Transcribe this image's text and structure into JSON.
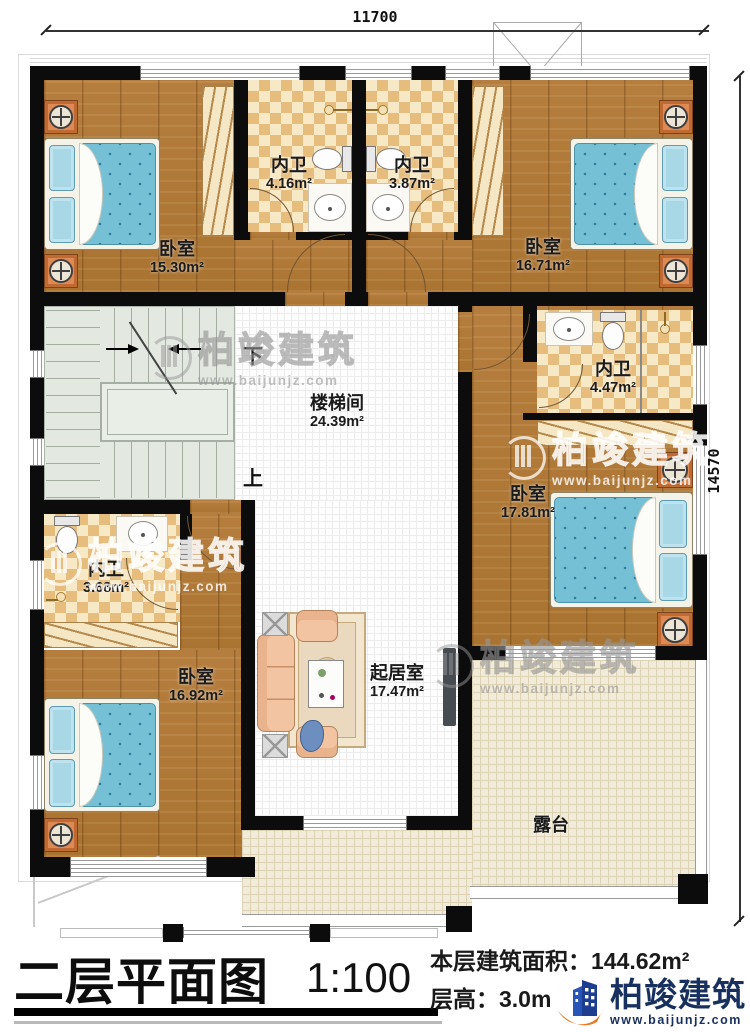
{
  "plan": {
    "dimensions": {
      "width_top": "11700",
      "height_right": "14570"
    },
    "stair_labels": {
      "down": "下",
      "up": "上"
    },
    "rooms": {
      "bedroom_tl": {
        "name": "卧室",
        "area": "15.30m²"
      },
      "bath_t1": {
        "name": "内卫",
        "area": "4.16m²"
      },
      "bath_t2": {
        "name": "内卫",
        "area": "3.87m²"
      },
      "bedroom_tr": {
        "name": "卧室",
        "area": "16.71m²"
      },
      "stair_hall": {
        "name": "楼梯间",
        "area": "24.39m²"
      },
      "bath_r": {
        "name": "内卫",
        "area": "4.47m²"
      },
      "bedroom_r": {
        "name": "卧室",
        "area": "17.81m²"
      },
      "bath_bl": {
        "name": "内卫",
        "area": "3.68m²"
      },
      "bedroom_bl": {
        "name": "卧室",
        "area": "16.92m²"
      },
      "living": {
        "name": "起居室",
        "area": "17.47m²"
      },
      "terrace": {
        "name": "露台"
      }
    }
  },
  "title_block": {
    "title": "二层平面图",
    "scale": "1:100",
    "building_area": "本层建筑面积：144.62m²",
    "floor_height": "层高：3.0m"
  },
  "brand": {
    "name": "柏竣建筑",
    "website": "www.baijunjz.com"
  },
  "watermark": {
    "name": "柏竣建筑",
    "website": "www.baijunjz.com"
  },
  "colors": {
    "wall": "#0c0c0c",
    "wood_floor": "#b1793a",
    "tile_light": "#f8e9c6",
    "tile_dark": "#e7bd7e",
    "stair_floor": "#e3e8e0",
    "terrace_floor": "#f1ecd9",
    "bed_blue": "#76c0d6",
    "furniture_orange": "#dd8a55",
    "sofa_peach": "#f2c4a2",
    "logo_blue": "#1d3e8f",
    "logo_orange": "#e87c26"
  }
}
